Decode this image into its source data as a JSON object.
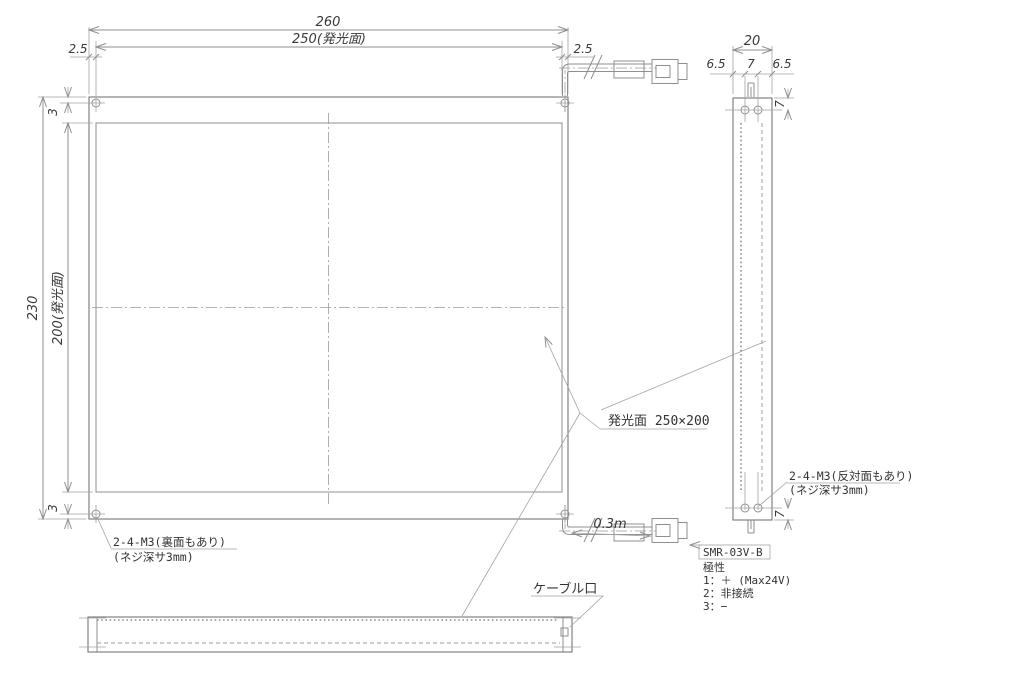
{
  "front": {
    "dim_total_w": "260",
    "dim_emit_w": "250(発光面)",
    "dim_edge_l": "2.5",
    "dim_edge_r": "2.5",
    "dim_total_h": "230",
    "dim_emit_h": "200(発光面)",
    "dim_hole_top": "3",
    "dim_hole_bot": "3"
  },
  "side": {
    "dim_w": "20",
    "dim_l": "6.5",
    "dim_c": "7",
    "dim_r": "6.5",
    "dim_hole_top": "7",
    "dim_hole_bot": "7"
  },
  "labels": {
    "emit_area": "発光面 250×200",
    "screw_front_l1": "2-4-M3(裏面もあり)",
    "screw_front_l2": "(ネジ深サ3mm)",
    "screw_side_l1": "2-4-M3(反対面もあり)",
    "screw_side_l2": "(ネジ深サ3mm)",
    "cable_port": "ケーブル口",
    "cable_length": "0.3m"
  },
  "connector": {
    "model": "SMR-03V-B",
    "polarity_title": "極性",
    "pin1": "1：＋ (Max24V)",
    "pin2": "2：非接続",
    "pin3": "3：−"
  },
  "colors": {
    "line": "#8f8f8f",
    "outline": "#767676",
    "text": "#3a3a3a",
    "background": "#ffffff"
  }
}
